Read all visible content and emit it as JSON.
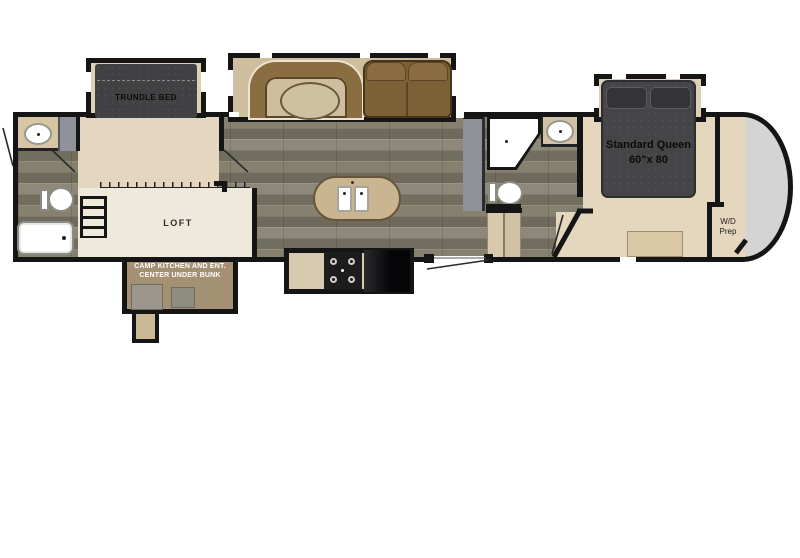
{
  "diagram": {
    "type": "rv-fifth-wheel-floor-plan",
    "labels": {
      "trundle_bed": "TRUNDLE BED",
      "loft": "LOFT",
      "camp_kitchen": [
        "CAMP KITCHEN AND ENT.",
        "CENTER UNDER BUNK"
      ],
      "queen_bed": [
        "Standard Queen",
        "60\"x 80"
      ],
      "wd_prep": [
        "W/D",
        "Prep"
      ]
    },
    "colors": {
      "wall": "#151515",
      "wood_floor": "#7e7968",
      "room_tan": "#e5d7bf",
      "loft_cream": "#efe9db",
      "slide_floor": "#dcd0b6",
      "dinette_floor": "#cfbe9e",
      "furniture_dark": "#454547",
      "booth_brown": "#8a6d41",
      "sofa_brown": "#7d6136",
      "island_tan": "#c9b590",
      "cabinet_gray": "#8f9196",
      "front_cap_gray": "#d4d4d4",
      "camp_kitchen_brown": "#a49173"
    },
    "fixtures": [
      "trundle-bed",
      "u-dinette-with-table",
      "loveseat-sofa",
      "kitchen-island-double-sink",
      "range",
      "refrigerator",
      "bathroom-sink",
      "toilet",
      "bathtub",
      "corner-shower",
      "loft-ladder",
      "entry-steps",
      "queen-bed",
      "bedroom-bench",
      "wardrobe",
      "wd-prep-closet",
      "camp-kitchen",
      "front-cap"
    ]
  }
}
